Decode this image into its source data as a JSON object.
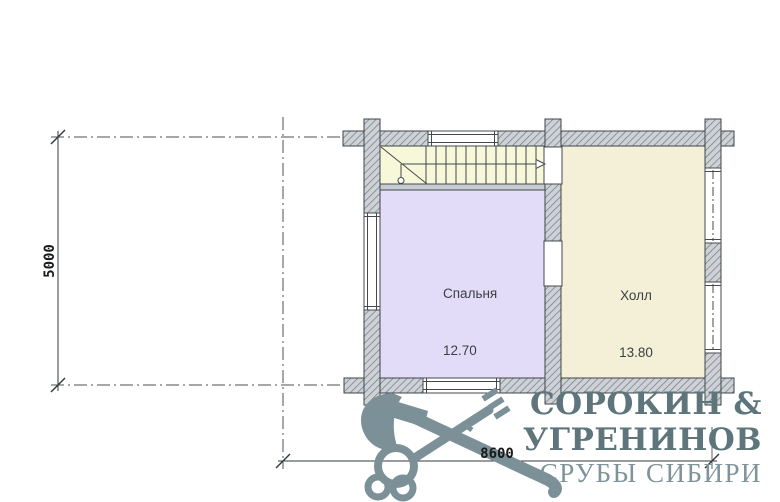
{
  "plan": {
    "rooms": [
      {
        "name": "Спальня",
        "area": "12.70"
      },
      {
        "name": "Холл",
        "area": "13.80"
      }
    ],
    "dimensions": {
      "height_mm": "5000",
      "width_mm": "8600"
    }
  },
  "logo": {
    "line1": "СОРОКИН &",
    "line2": "УГРЕНИНОВ",
    "line3": "СРУБЫ СИБИРИ"
  },
  "colors": {
    "stairs_fill": "#f7f8d9",
    "bedroom_fill": "#e2dcf8",
    "hall_fill": "#f4f0d8",
    "wall_fill": "#ced2d6",
    "line": "#3f444a",
    "logo": "#7b9097"
  }
}
